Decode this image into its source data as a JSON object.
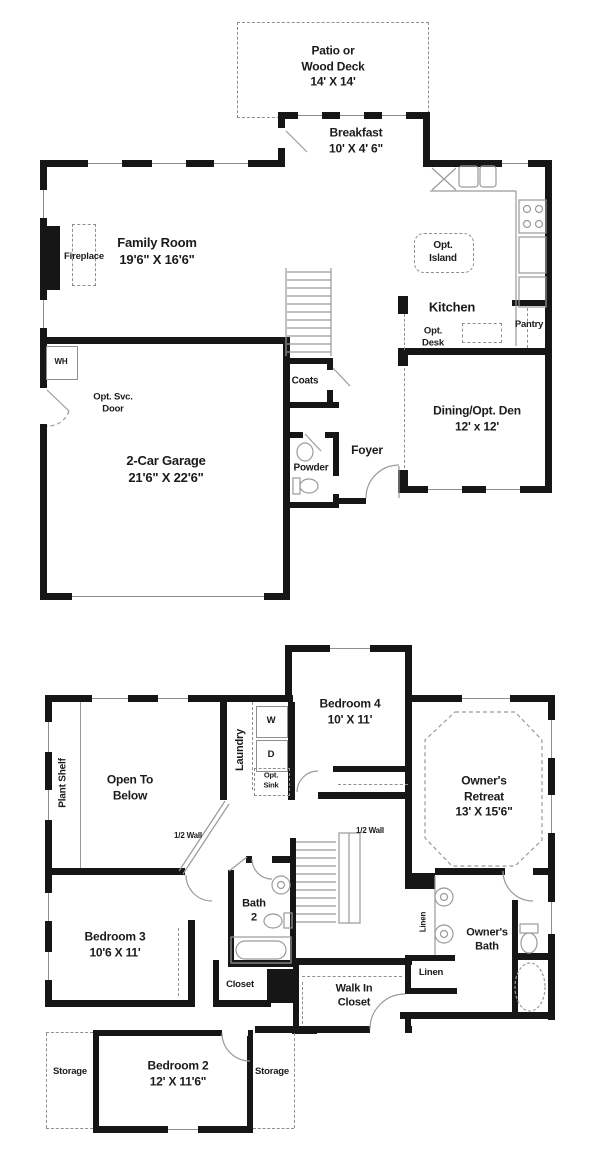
{
  "meta": {
    "title": "Two-story home floor plan"
  },
  "colors": {
    "wall": "#161616",
    "thin_line": "#8f8f8f",
    "text": "#1b1b1b",
    "bg": "#ffffff"
  },
  "first_floor": {
    "patio": {
      "line1": "Patio or",
      "line2": "Wood Deck",
      "dims": "14' X 14'"
    },
    "breakfast": {
      "name": "Breakfast",
      "dims": "10' X 4' 6\""
    },
    "family_room": {
      "name": "Family Room",
      "dims": "19'6\" X 16'6\""
    },
    "fireplace": {
      "name": "Fireplace"
    },
    "water_heater": {
      "name": "WH"
    },
    "opt_svc_door": {
      "line1": "Opt. Svc.",
      "line2": "Door"
    },
    "garage": {
      "name": "2-Car Garage",
      "dims": "21'6\" X 22'6\""
    },
    "coats": {
      "name": "Coats"
    },
    "powder": {
      "name": "Powder"
    },
    "foyer": {
      "name": "Foyer"
    },
    "kitchen": {
      "name": "Kitchen"
    },
    "opt_island": {
      "line1": "Opt.",
      "line2": "Island"
    },
    "pantry": {
      "name": "Pantry"
    },
    "opt_desk": {
      "line1": "Opt.",
      "line2": "Desk"
    },
    "dining": {
      "name": "Dining/Opt. Den",
      "dims": "12' x 12'"
    }
  },
  "second_floor": {
    "bedroom4": {
      "name": "Bedroom 4",
      "dims": "10' X 11'"
    },
    "owners_retreat": {
      "line1": "Owner's",
      "line2": "Retreat",
      "dims": "13' X 15'6\""
    },
    "laundry": {
      "name": "Laundry"
    },
    "washer": {
      "name": "W"
    },
    "dryer": {
      "name": "D"
    },
    "opt_sink": {
      "line1": "Opt.",
      "line2": "Sink"
    },
    "plant_shelf": {
      "name": "Plant Shelf"
    },
    "open_to_below": {
      "line1": "Open To",
      "line2": "Below"
    },
    "half_wall_left": {
      "name": "1/2 Wall"
    },
    "half_wall_stairs": {
      "name": "1/2 Wall"
    },
    "bath2": {
      "line1": "Bath",
      "line2": "2"
    },
    "bedroom3": {
      "name": "Bedroom 3",
      "dims": "10'6 X 11'"
    },
    "owners_bath": {
      "line1": "Owner's",
      "line2": "Bath"
    },
    "linen_tall": {
      "name": "Linen"
    },
    "linen": {
      "name": "Linen"
    },
    "closet": {
      "name": "Closet"
    },
    "walk_in_closet": {
      "line1": "Walk In",
      "line2": "Closet"
    },
    "bedroom2": {
      "name": "Bedroom 2",
      "dims": "12' X 11'6\""
    },
    "storage_left": {
      "name": "Storage"
    },
    "storage_right": {
      "name": "Storage"
    }
  }
}
